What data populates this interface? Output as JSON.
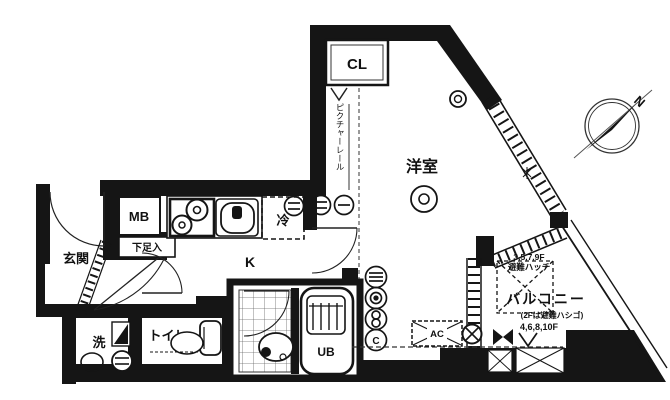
{
  "plan": {
    "rooms": {
      "genkan": "玄関",
      "mb": "MB",
      "shoe_box": "下足入",
      "kitchen": "K",
      "fridge": "冷",
      "closet": "CL",
      "picture_rail": "ピクチャーレール",
      "western_room": "洋室",
      "wash": "洗",
      "toilet": "トイレ",
      "unit_bath": "UB",
      "balcony": "バルコニー"
    },
    "annotations": {
      "hatch_floors": "3,5,7,9F",
      "hatch_label": "避難ハッチ",
      "ladder_note": "(2Fは避難ハシゴ)",
      "other_floors": "4,6,8,10F",
      "ac": "AC",
      "compass_north": "N",
      "outlet_c": "C"
    },
    "colors": {
      "wall": "#151515",
      "line": "#222222",
      "background": "#ffffff"
    }
  }
}
